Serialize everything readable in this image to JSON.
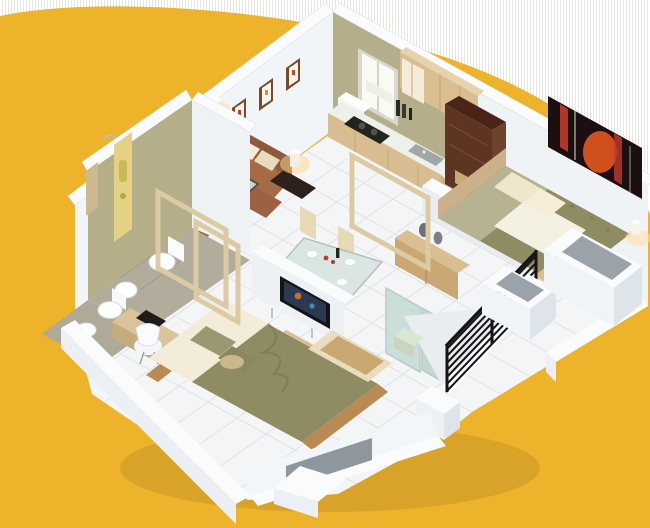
{
  "image": {
    "kind": "3d-floor-plan-cutaway-render",
    "width": 650,
    "height": 528,
    "view": "isometric birds-eye"
  },
  "palette": {
    "background_white": "#FFFFFF",
    "background_stripe": "#E9E6E0",
    "blob_orange": "#EDB32B",
    "wall_top_white": "#FAFBFD",
    "wall_face_light": "#F1F4F7",
    "wall_face_mid": "#E4EAEF",
    "wall_face_dark": "#D7DEE5",
    "wall_olive": "#B4AF8A",
    "floor_tile": "#F3F5F6",
    "floor_grout": "#DCE1E4",
    "bathroom_floor": "#B1AB9B",
    "door_wood": "#9A6A35",
    "sofa_brown": "#A56B44",
    "ottoman_brown": "#9A6243",
    "cushion_cream": "#EFE6CC",
    "bed_olive": "#8F8C64",
    "bed_sheet_cream": "#F2ECD8",
    "headboard_tan": "#CBB088",
    "wood_light": "#D9BE92",
    "wood_frame_tan": "#DCCBA2",
    "wood_dark_walnut": "#5E3423",
    "railing_black": "#151515",
    "glass_green": "#BFDAD2",
    "lamp_glow": "#FFD98F",
    "tv_black": "#141414",
    "painting_dark": "#1C0F12",
    "painting_orange": "#E0561E",
    "shower_panel_yellow": "#E3D284"
  },
  "rooms": [
    {
      "id": "living-room",
      "furniture": [
        "brown-sofa",
        "cream-cushions",
        "two-ottomans",
        "glass-coffee-table",
        "two-side-tables-with-lamps",
        "three-wall-frames"
      ]
    },
    {
      "id": "entry-hall",
      "furniture": [
        "wooden-entry-door",
        "wall-lamp-glow",
        "wood-portal-frames"
      ]
    },
    {
      "id": "kitchen",
      "furniture": [
        "window-with-curtain",
        "upper-wood-cabinets",
        "counter-with-gas-hob",
        "sink",
        "fridge",
        "bottles"
      ]
    },
    {
      "id": "master-bedroom",
      "furniture": [
        "double-bed-olive-duvet",
        "cream-pillows",
        "white-throw",
        "headboard",
        "foot-bench",
        "bedside-lamp",
        "dark-wardrobe-study-unit",
        "white-chair",
        "red-abstract-painting"
      ]
    },
    {
      "id": "second-bedroom",
      "furniture": [
        "double-bed-olive-blanket",
        "pillows",
        "desk-with-black-machine",
        "white-swivel-chair",
        "tv-on-low-wall",
        "tv-bench",
        "foot-wardrobe"
      ]
    },
    {
      "id": "bathroom-shower",
      "furniture": [
        "shower-panel",
        "toilet",
        "wash-basin",
        "mirror-cabinet"
      ]
    },
    {
      "id": "bathroom-second",
      "furniture": [
        "toilet",
        "bidet"
      ]
    },
    {
      "id": "dining-area",
      "furniture": [
        "glass-dining-table",
        "four-cream-chairs",
        "plates",
        "wine-and-flowers",
        "buffet-cabinet-with-vases"
      ]
    },
    {
      "id": "balcony",
      "furniture": [
        "black-metal-railing",
        "white-pillars",
        "glass-sliding-partition",
        "side-stool",
        "planter-window-boxes"
      ]
    }
  ]
}
